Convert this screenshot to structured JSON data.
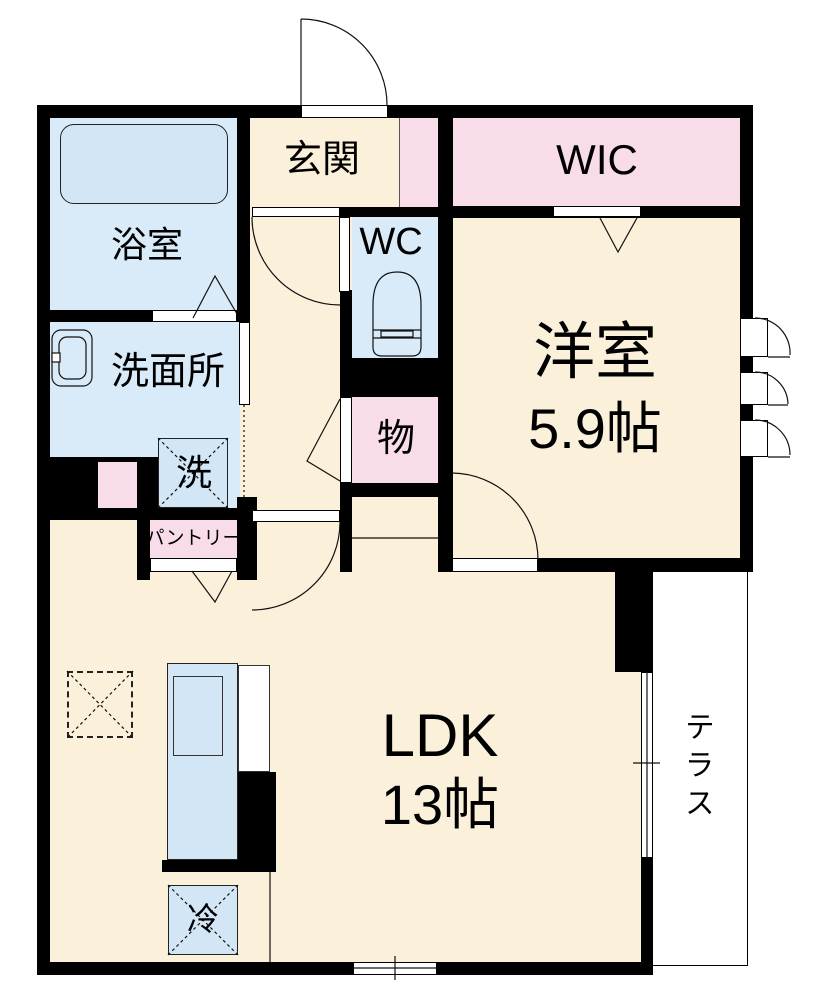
{
  "plan_title": "1LDK apartment floor plan",
  "rooms": {
    "genkan": {
      "label": "玄関"
    },
    "wic": {
      "label": "WIC"
    },
    "bathroom": {
      "label": "浴室"
    },
    "washroom": {
      "label": "洗面所"
    },
    "wc": {
      "label": "WC"
    },
    "laundry": {
      "label": "洗"
    },
    "storage": {
      "label": "物"
    },
    "pantry": {
      "label": "パントリー"
    },
    "western_room": {
      "label": "洋室",
      "size": "5.9帖"
    },
    "ldk": {
      "label": "LDK",
      "size": "13帖"
    },
    "terrace": {
      "label": "テラス"
    },
    "refrigerator": {
      "label": "冷"
    }
  },
  "colors": {
    "wall": "#000000",
    "room_cream": "#FBF1DB",
    "closet_pink": "#F8DCE9",
    "wet_area_blue": "#D9EAF8",
    "fixture_blue": "#D3E6F6",
    "terrace_white": "#FFFFFF"
  }
}
